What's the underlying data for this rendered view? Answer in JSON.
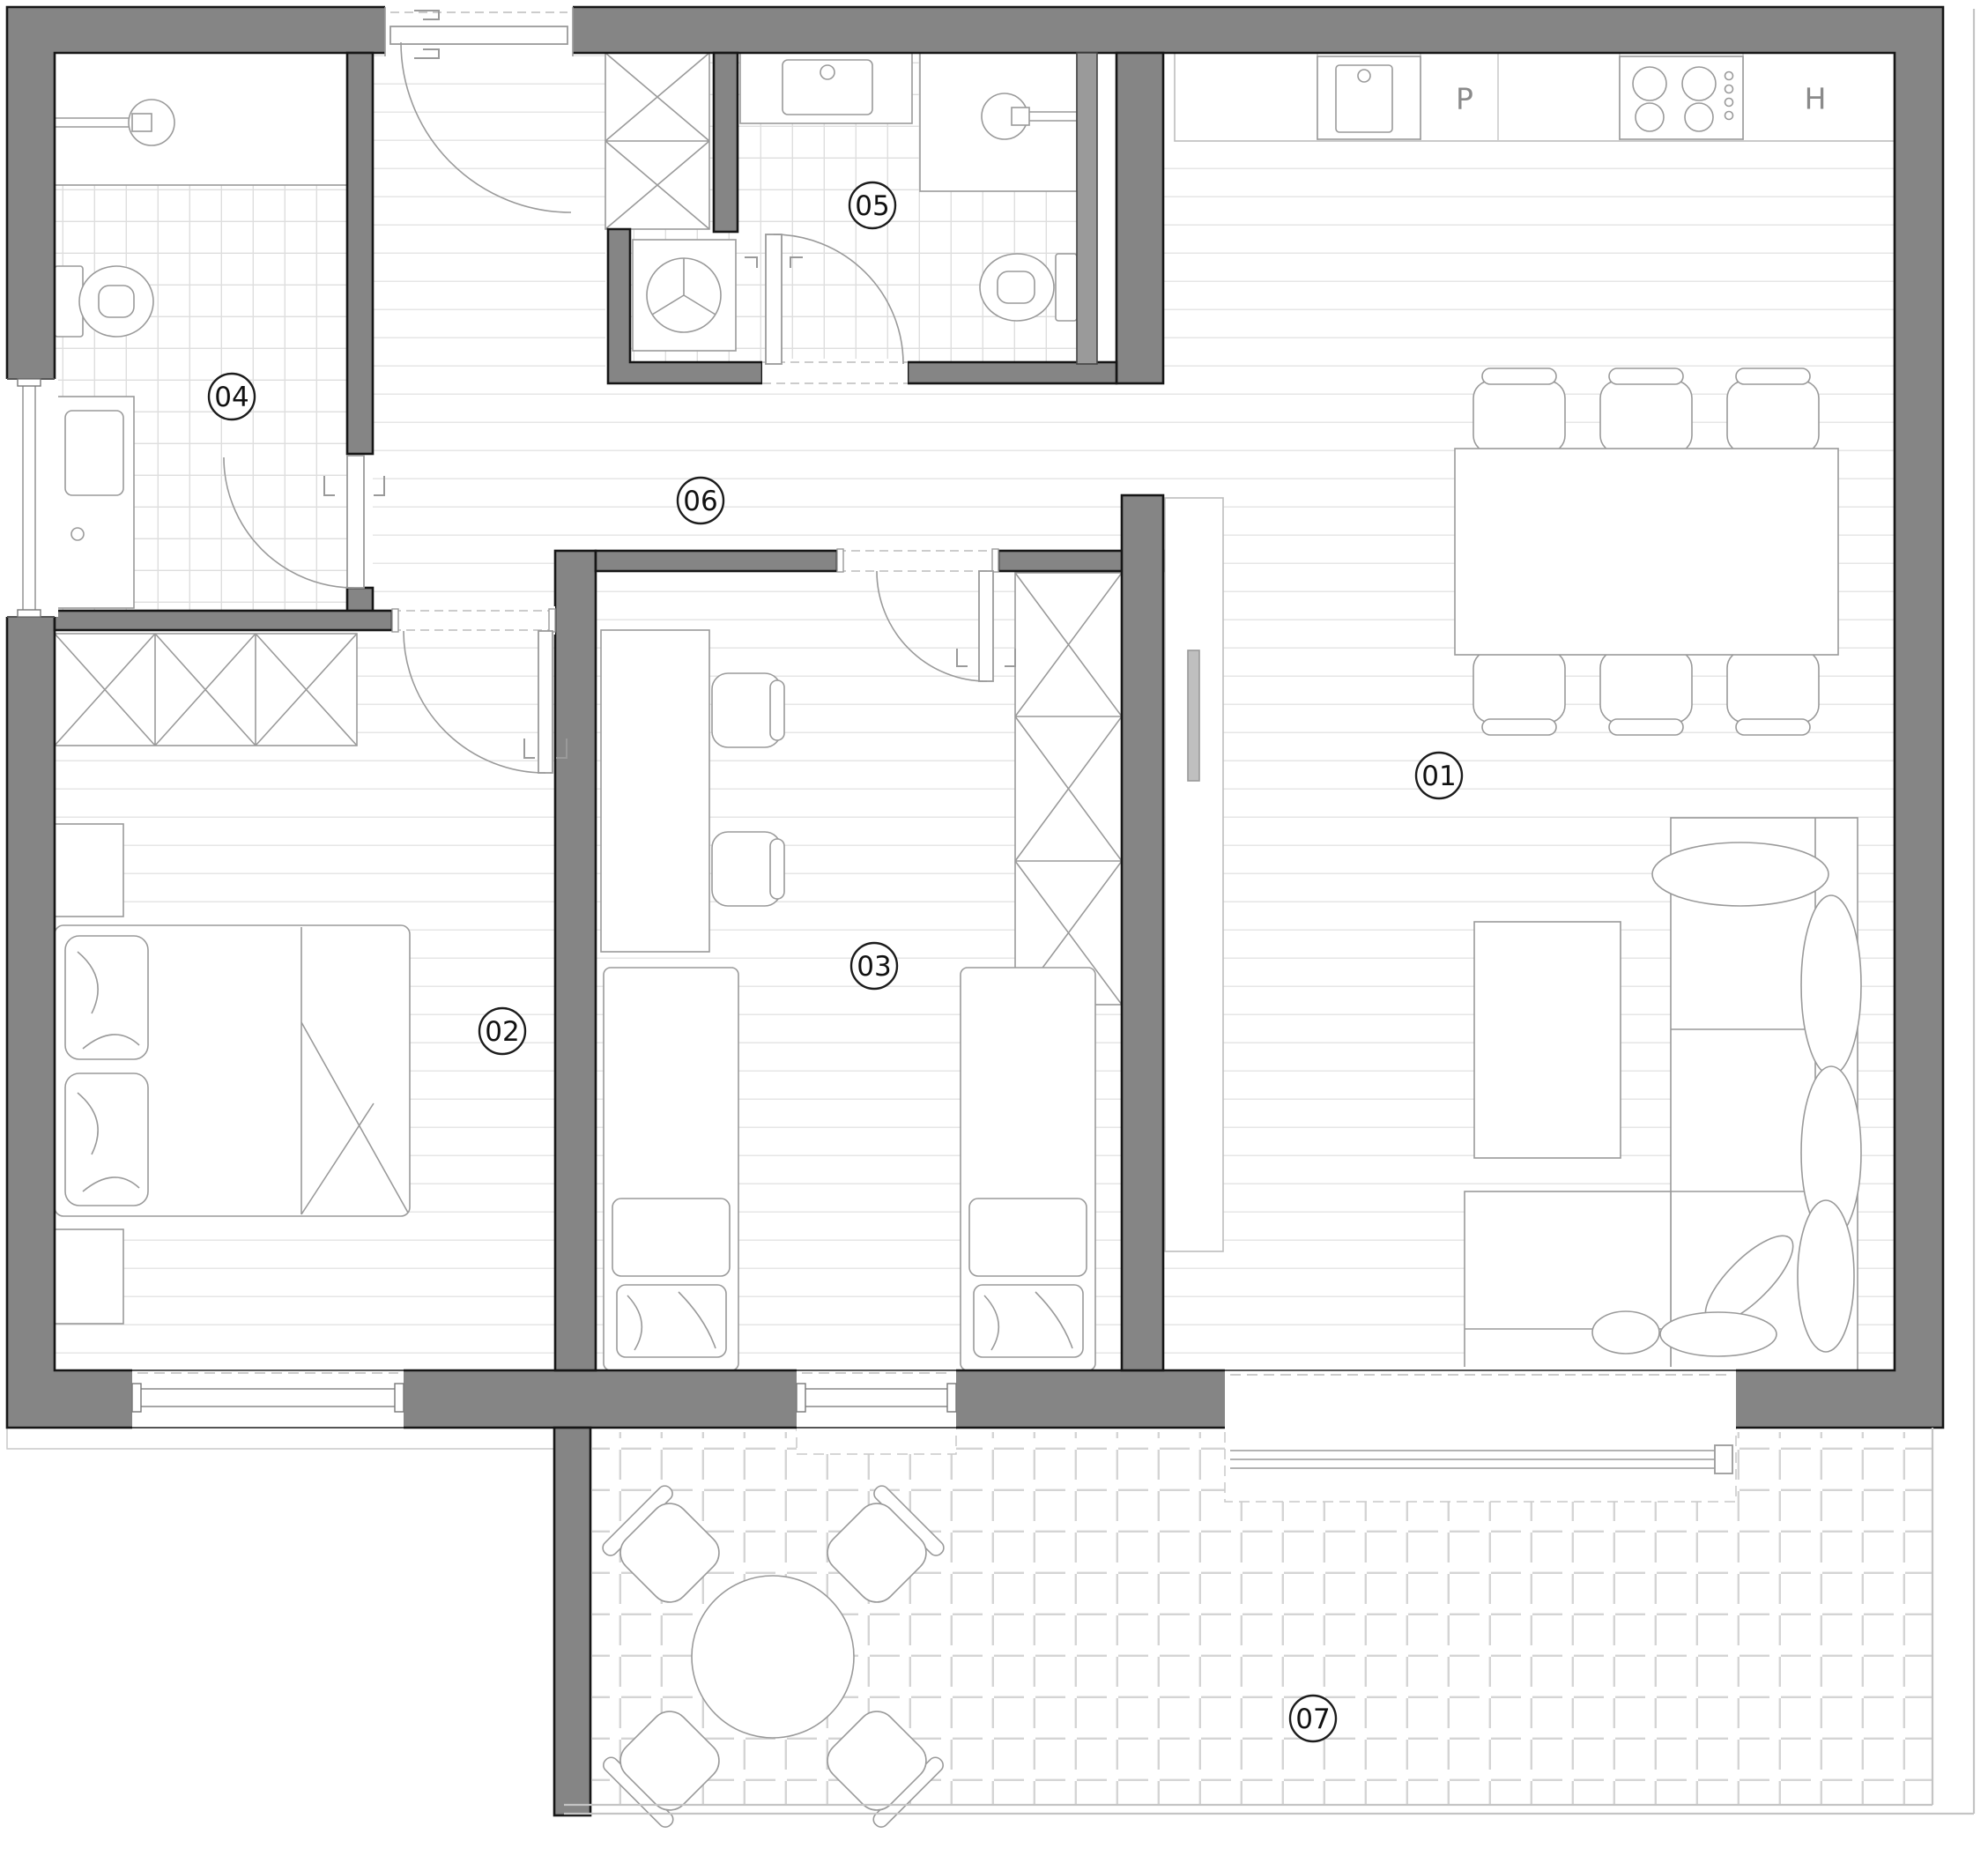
{
  "plan_title": "apartment-floor-plan",
  "rooms": [
    {
      "label": "01",
      "kind": "living-kitchen"
    },
    {
      "label": "02",
      "kind": "bedroom"
    },
    {
      "label": "03",
      "kind": "kids-bedroom"
    },
    {
      "label": "04",
      "kind": "bathroom"
    },
    {
      "label": "05",
      "kind": "bathroom"
    },
    {
      "label": "06",
      "kind": "hallway"
    },
    {
      "label": "07",
      "kind": "terrace"
    }
  ],
  "kitchen": {
    "dishwasher_label": "P",
    "fridge_label": "H"
  },
  "colors": {
    "wall_fill": "#858585",
    "wall_line": "#161616",
    "furniture_line": "#9a9a9a",
    "plank_line": "#e6e6e6",
    "bath_tile_line": "#dedede",
    "terrace_tile_line": "#d4d4d4",
    "label_ink": "#111111"
  }
}
